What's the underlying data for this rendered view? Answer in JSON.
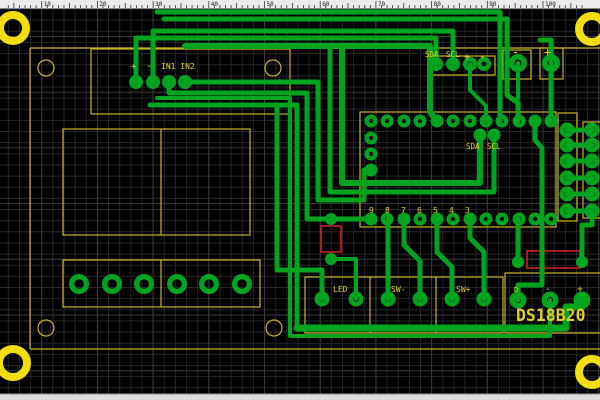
{
  "window": {
    "ruler": {
      "unit_px": 5.57,
      "origin_x": 41.7,
      "labels": [
        "10",
        "20",
        "30",
        "40",
        "50",
        "60",
        "70",
        "80",
        "90",
        "100"
      ]
    },
    "scrollbar_bottom": true
  },
  "pcb": {
    "colors": {
      "background": "#000000",
      "grid_minor": "#262626",
      "grid_major": "#3b3b3b",
      "copper": "#00A41E",
      "silk_line": "#C9B524",
      "silk_text": "#E2CE28",
      "mount_ring": "#F2DE0C",
      "bottom_layer_red": "#CC2020",
      "ruler_bg": "#EBEBEB",
      "ruler_tick": "#333333",
      "scrollbar_bg": "#DCDCDC"
    },
    "mount_rings": [
      {
        "cx": 13,
        "cy": 28,
        "r": 13,
        "w": 8
      },
      {
        "cx": 592,
        "cy": 29,
        "r": 13,
        "w": 8
      },
      {
        "cx": 13,
        "cy": 363,
        "r": 14,
        "w": 8
      },
      {
        "cx": 592,
        "cy": 372,
        "r": 13,
        "w": 8
      }
    ],
    "silk_segments": [
      [
        30,
        48,
        600,
        48
      ],
      [
        30,
        48,
        30,
        349
      ],
      [
        30,
        349,
        600,
        349
      ]
    ],
    "silk_rects": [
      {
        "x": 91,
        "y": 49,
        "w": 199,
        "h": 65
      },
      {
        "x": 63,
        "y": 129,
        "w": 187,
        "h": 106
      },
      {
        "x": 63,
        "y": 260,
        "w": 197,
        "h": 47
      },
      {
        "x": 429,
        "y": 56,
        "w": 66,
        "h": 19
      },
      {
        "x": 503,
        "y": 50,
        "w": 28,
        "h": 29
      },
      {
        "x": 540,
        "y": 48,
        "w": 23,
        "h": 31
      },
      {
        "x": 360,
        "y": 112,
        "w": 196,
        "h": 115
      },
      {
        "x": 558,
        "y": 113,
        "w": 19,
        "h": 108
      },
      {
        "x": 583,
        "y": 122,
        "w": 18,
        "h": 96
      },
      {
        "x": 305,
        "y": 277,
        "w": 198,
        "h": 56
      },
      {
        "x": 505,
        "y": 273,
        "w": 96,
        "h": 60
      }
    ],
    "silk_dividers": [
      [
        161,
        129,
        161,
        235
      ],
      [
        161,
        260,
        161,
        307
      ],
      [
        370,
        277,
        370,
        333
      ],
      [
        436,
        277,
        436,
        333
      ]
    ],
    "silk_circles": [
      {
        "cx": 46,
        "cy": 68,
        "r": 8
      },
      {
        "cx": 273,
        "cy": 68,
        "r": 8
      },
      {
        "cx": 46,
        "cy": 328,
        "r": 8
      },
      {
        "cx": 274,
        "cy": 328,
        "r": 8
      }
    ],
    "red_rects": [
      {
        "x": 321,
        "y": 226,
        "w": 20,
        "h": 26
      },
      {
        "x": 527,
        "y": 251,
        "w": 53,
        "h": 17
      }
    ],
    "traces": [
      {
        "w": 5,
        "pts": [
          [
            136,
            82
          ],
          [
            136,
            38
          ],
          [
            436,
            38
          ],
          [
            436,
            64
          ]
        ]
      },
      {
        "w": 5,
        "pts": [
          [
            153,
            82
          ],
          [
            153,
            31
          ],
          [
            453,
            31
          ],
          [
            453,
            64
          ]
        ]
      },
      {
        "w": 5,
        "pts": [
          [
            157,
            12
          ],
          [
            500,
            12
          ],
          [
            500,
            121
          ]
        ]
      },
      {
        "w": 5,
        "pts": [
          [
            164,
            19
          ],
          [
            507,
            19
          ],
          [
            507,
            95
          ],
          [
            518,
            103
          ],
          [
            518,
            121
          ]
        ]
      },
      {
        "w": 4,
        "pts": [
          [
            518,
            63
          ],
          [
            518,
            99
          ]
        ]
      },
      {
        "w": 5,
        "pts": [
          [
            540,
            40
          ],
          [
            551,
            40
          ],
          [
            551,
            121
          ]
        ]
      },
      {
        "w": 5,
        "pts": [
          [
            169,
            82
          ],
          [
            169,
            93
          ],
          [
            307,
            93
          ],
          [
            307,
            219
          ],
          [
            371,
            219
          ]
        ]
      },
      {
        "w": 5,
        "pts": [
          [
            185,
            82
          ],
          [
            318,
            82
          ],
          [
            318,
            200
          ],
          [
            364,
            200
          ],
          [
            364,
            170
          ],
          [
            371,
            170
          ]
        ]
      },
      {
        "w": 6,
        "pts": [
          [
            480,
            135
          ],
          [
            480,
            183
          ],
          [
            342,
            183
          ],
          [
            342,
            47
          ]
        ]
      },
      {
        "w": 5,
        "pts": [
          [
            494,
            135
          ],
          [
            494,
            192
          ],
          [
            330,
            192
          ],
          [
            330,
            47
          ]
        ]
      },
      {
        "w": 5,
        "pts": [
          [
            150,
            105
          ],
          [
            297,
            105
          ],
          [
            297,
            325
          ]
        ]
      },
      {
        "w": 7,
        "pts": [
          [
            297,
            328
          ],
          [
            566,
            328
          ],
          [
            566,
            307
          ],
          [
            582,
            307
          ],
          [
            582,
            300
          ]
        ]
      },
      {
        "w": 4,
        "pts": [
          [
            157,
            98
          ],
          [
            290,
            98
          ],
          [
            290,
            336
          ],
          [
            550,
            336
          ],
          [
            550,
            300
          ]
        ]
      },
      {
        "w": 5,
        "pts": [
          [
            535,
            121
          ],
          [
            535,
            140
          ],
          [
            542,
            148
          ],
          [
            542,
            285
          ],
          [
            518,
            285
          ],
          [
            518,
            300
          ]
        ]
      },
      {
        "w": 5,
        "pts": [
          [
            388,
            219
          ],
          [
            388,
            299
          ]
        ]
      },
      {
        "w": 5,
        "pts": [
          [
            404,
            219
          ],
          [
            404,
            245
          ],
          [
            420,
            261
          ],
          [
            420,
            299
          ]
        ]
      },
      {
        "w": 5,
        "pts": [
          [
            470,
            219
          ],
          [
            470,
            238
          ],
          [
            484,
            252
          ],
          [
            484,
            299
          ]
        ]
      },
      {
        "w": 5,
        "pts": [
          [
            437,
            219
          ],
          [
            437,
            252
          ],
          [
            452,
            267
          ],
          [
            452,
            299
          ]
        ]
      },
      {
        "w": 5,
        "pts": [
          [
            277,
            108
          ],
          [
            277,
            270
          ],
          [
            322,
            270
          ],
          [
            322,
            299
          ]
        ]
      },
      {
        "w": 5,
        "pts": [
          [
            518,
            219
          ],
          [
            518,
            262
          ]
        ]
      },
      {
        "w": 5,
        "pts": [
          [
            582,
            262
          ],
          [
            582,
            225
          ],
          [
            592,
            225
          ],
          [
            592,
            211
          ]
        ]
      },
      {
        "w": 6,
        "pts": [
          [
            185,
            46
          ],
          [
            430,
            46
          ],
          [
            430,
            112
          ],
          [
            437,
            121
          ]
        ]
      },
      {
        "w": 4,
        "pts": [
          [
            470,
            64
          ],
          [
            470,
            90
          ],
          [
            486,
            106
          ],
          [
            486,
            121
          ]
        ]
      },
      {
        "w": 4,
        "pts": [
          [
            331,
            259
          ],
          [
            356,
            259
          ],
          [
            356,
            299
          ]
        ]
      },
      {
        "w": 5,
        "pts": [
          [
            567,
            130
          ],
          [
            592,
            130
          ]
        ]
      },
      {
        "w": 5,
        "pts": [
          [
            567,
            145
          ],
          [
            592,
            145
          ]
        ]
      },
      {
        "w": 5,
        "pts": [
          [
            567,
            161
          ],
          [
            592,
            161
          ]
        ]
      },
      {
        "w": 5,
        "pts": [
          [
            567,
            178
          ],
          [
            592,
            178
          ]
        ]
      },
      {
        "w": 5,
        "pts": [
          [
            567,
            194
          ],
          [
            592,
            194
          ]
        ]
      },
      {
        "w": 5,
        "pts": [
          [
            567,
            211
          ],
          [
            592,
            211
          ]
        ]
      }
    ],
    "pad_groups": [
      {
        "name": "in-header",
        "r": 7,
        "h": 2.5,
        "pts": [
          [
            136,
            82
          ],
          [
            153,
            82
          ],
          [
            169,
            82
          ],
          [
            185,
            82
          ]
        ]
      },
      {
        "name": "sda-scl-header",
        "r": 7,
        "h": 2.5,
        "pts": [
          [
            436,
            64
          ],
          [
            453,
            64
          ],
          [
            470,
            64
          ],
          [
            484,
            64
          ]
        ]
      },
      {
        "name": "power-pads",
        "r": 9,
        "h": 3.5,
        "pts": [
          [
            518,
            63
          ],
          [
            551,
            63
          ]
        ]
      },
      {
        "name": "ic-top-row",
        "r": 6.5,
        "h": 2.2,
        "pts": [
          [
            371,
            121
          ],
          [
            387,
            121
          ],
          [
            404,
            121
          ],
          [
            420,
            121
          ],
          [
            437,
            121
          ],
          [
            453,
            121
          ],
          [
            470,
            121
          ],
          [
            486,
            121
          ],
          [
            502,
            121
          ],
          [
            519,
            121
          ],
          [
            535,
            121
          ],
          [
            551,
            121
          ]
        ]
      },
      {
        "name": "ic-bottom-row",
        "r": 6.5,
        "h": 2.2,
        "pts": [
          [
            371,
            219
          ],
          [
            387,
            219
          ],
          [
            404,
            219
          ],
          [
            420,
            219
          ],
          [
            437,
            219
          ],
          [
            453,
            219
          ],
          [
            470,
            219
          ],
          [
            486,
            219
          ],
          [
            502,
            219
          ],
          [
            519,
            219
          ],
          [
            535,
            219
          ],
          [
            551,
            219
          ]
        ]
      },
      {
        "name": "ic-left-col",
        "r": 6.5,
        "h": 2.2,
        "pts": [
          [
            371,
            138
          ],
          [
            371,
            154
          ],
          [
            371,
            170
          ]
        ]
      },
      {
        "name": "sda-scl-vias",
        "r": 6.5,
        "h": 2.2,
        "pts": [
          [
            480,
            135
          ],
          [
            494,
            135
          ]
        ]
      },
      {
        "name": "right-conn-a",
        "r": 7.5,
        "h": 2.8,
        "pts": [
          [
            567,
            130
          ],
          [
            567,
            145
          ],
          [
            567,
            161
          ],
          [
            567,
            178
          ],
          [
            567,
            194
          ],
          [
            567,
            211
          ]
        ]
      },
      {
        "name": "right-conn-b",
        "r": 7.5,
        "h": 2.8,
        "pts": [
          [
            592,
            130
          ],
          [
            592,
            145
          ],
          [
            592,
            161
          ],
          [
            592,
            178
          ],
          [
            592,
            194
          ],
          [
            592,
            211
          ]
        ]
      },
      {
        "name": "terminal-block",
        "r": 10,
        "h": 4.8,
        "pts": [
          [
            79,
            284
          ],
          [
            112,
            284
          ],
          [
            144,
            284
          ],
          [
            177,
            284
          ],
          [
            209,
            284
          ],
          [
            242,
            284
          ]
        ]
      },
      {
        "name": "led-pads",
        "r": 7.5,
        "h": 2.8,
        "pts": [
          [
            322,
            299
          ],
          [
            356,
            299
          ]
        ]
      },
      {
        "name": "sw-minus-pads",
        "r": 7.5,
        "h": 2.8,
        "pts": [
          [
            388,
            299
          ],
          [
            420,
            299
          ]
        ]
      },
      {
        "name": "sw-plus-pads",
        "r": 7.5,
        "h": 2.8,
        "pts": [
          [
            452,
            299
          ],
          [
            484,
            299
          ]
        ]
      },
      {
        "name": "ds18b20-pads",
        "r": 8.5,
        "h": 3,
        "pts": [
          [
            518,
            300
          ],
          [
            550,
            300
          ],
          [
            582,
            300
          ]
        ]
      },
      {
        "name": "vias",
        "r": 6,
        "h": 2,
        "pts": [
          [
            331,
            219
          ],
          [
            331,
            259
          ],
          [
            518,
            262
          ],
          [
            582,
            262
          ]
        ]
      }
    ],
    "labels": [
      {
        "t": "+",
        "x": 131,
        "y": 69,
        "s": 9
      },
      {
        "t": "-",
        "x": 146,
        "y": 69,
        "s": 10
      },
      {
        "t": "IN1 IN2",
        "x": 161,
        "y": 69,
        "s": 8
      },
      {
        "t": "SDA",
        "x": 425,
        "y": 57,
        "s": 7.5
      },
      {
        "t": "SCL",
        "x": 446,
        "y": 57,
        "s": 7.5
      },
      {
        "t": "+",
        "x": 464,
        "y": 60,
        "s": 10
      },
      {
        "t": "-",
        "x": 479,
        "y": 60,
        "s": 11
      },
      {
        "t": "-",
        "x": 512,
        "y": 56,
        "s": 12
      },
      {
        "t": "+",
        "x": 544,
        "y": 56,
        "s": 12
      },
      {
        "t": "SDA",
        "x": 466,
        "y": 149,
        "s": 7.5
      },
      {
        "t": "SCL",
        "x": 487,
        "y": 149,
        "s": 7.5
      },
      {
        "t": "9",
        "x": 369,
        "y": 213,
        "s": 8
      },
      {
        "t": "8",
        "x": 385,
        "y": 213,
        "s": 8
      },
      {
        "t": "7",
        "x": 401,
        "y": 213,
        "s": 8
      },
      {
        "t": "6",
        "x": 417,
        "y": 213,
        "s": 8
      },
      {
        "t": "5",
        "x": 433,
        "y": 213,
        "s": 8
      },
      {
        "t": "4",
        "x": 449,
        "y": 213,
        "s": 8
      },
      {
        "t": "3",
        "x": 465,
        "y": 213,
        "s": 8
      },
      {
        "t": "LED",
        "x": 333,
        "y": 292,
        "s": 8
      },
      {
        "t": "SW-",
        "x": 391,
        "y": 292,
        "s": 8
      },
      {
        "t": "SW+",
        "x": 456,
        "y": 292,
        "s": 8
      },
      {
        "t": "D",
        "x": 514,
        "y": 292,
        "s": 7
      },
      {
        "t": "-",
        "x": 545,
        "y": 292,
        "s": 10
      },
      {
        "t": "+",
        "x": 577,
        "y": 292,
        "s": 10
      }
    ],
    "part_label": {
      "t": "DS18B20",
      "x": 516,
      "y": 321,
      "s": 16.5
    }
  }
}
